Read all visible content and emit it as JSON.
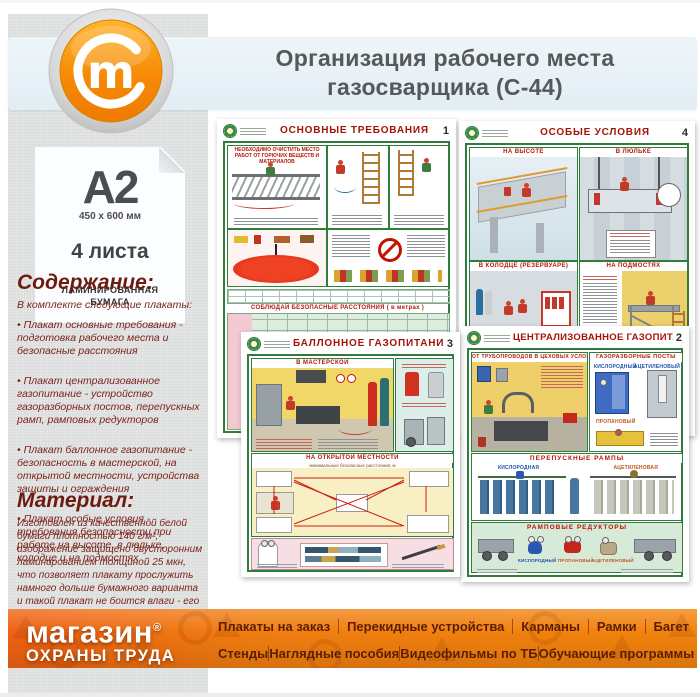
{
  "header": {
    "title_line1": "Организация рабочего места",
    "title_line2": "газосварщика (С-44)",
    "logo_letter": "m"
  },
  "sidebar": {
    "paper": {
      "format": "A2",
      "size": "450 x 600 мм",
      "sheets": "4 листа",
      "material_label": "ЛАМИНИРОВАННАЯ БУМАГА"
    },
    "contents": {
      "heading": "Содержание:",
      "intro": "В комплекте следующие плакаты:",
      "items": [
        "• Плакат основные требования - подготовка рабочего места и безопасные расстояния",
        "• Плакат централизованное газопитание - устройство газоразборных постов, перепускных рамп, рамповых редукторов",
        "• Плакат баллонное газопитание - безопасность в мастерской, на открытой местности, устройства защиты и ограждения",
        "• Плакат особые условия - требования безопасности при работе на высоте, в люльке, колодце и на подмостях"
      ]
    },
    "material": {
      "heading": "Материал:",
      "text": "Изготовлен из качественной белой бумаги плотностью 140 г/м², изображение защищено двусторонним ламинированием толщиной 25 мкн, что позволяет плакату прослужить намного дольше бумажного варианта и такой плакат не боится влаги - его смело можно протирать."
    }
  },
  "posters": {
    "p1": {
      "title": "ОСНОВНЫЕ ТРЕБОВАНИЯ",
      "number": "1",
      "s1": "НЕОБХОДИМО ОЧИСТИТЬ МЕСТО РАБОТ ОТ ГОРЮЧИХ ВЕЩЕСТВ И МАТЕРИАЛОВ",
      "s2": "СОБЛЮДАЙ БЕЗОПАСНЫЕ РАССТОЯНИЯ ( в метрах )"
    },
    "p2": {
      "title": "ОСОБЫЕ УСЛОВИЯ",
      "number": "4",
      "s1": "НА ВЫСОТЕ",
      "s2": "В ЛЮЛЬКЕ",
      "s3": "В КОЛОДЦЕ (РЕЗЕРВУАРЕ)",
      "s4": "НА ПОДМОСТЯХ"
    },
    "p3": {
      "title": "БАЛЛОННОЕ ГАЗОПИТАНИЕ",
      "number": "3",
      "s1": "В МАСТЕРСКОЙ",
      "s2": "НА ОТКРЫТОЙ МЕСТНОСТИ",
      "s2_sub": "минимальные безопасные расстояния, м"
    },
    "p4": {
      "title": "ЦЕНТРАЛИЗОВАННОЕ ГАЗОПИТАНИЕ",
      "number": "2",
      "s1": "ОТ ТРУБОПРОВОДОВ В ЦЕХОВЫХ УСЛОВИЯХ",
      "s2": "ГАЗОРАЗБОРНЫЕ ПОСТЫ",
      "s3": "ПЕРЕПУСКНЫЕ РАМПЫ",
      "s4": "РАМПОВЫЕ РЕДУКТОРЫ",
      "labels": {
        "oxygen_post": "КИСЛОРОДНЫЙ",
        "acetylene_post": "АЦЕТИЛЕНОВЫЙ",
        "propane_post": "ПРОПАНОВЫЙ",
        "oxygen_ramp": "КИСЛОРОДНАЯ",
        "acetylene_ramp": "АЦЕТИЛЕНОВАЯ",
        "oxygen_reducer": "КИСЛОРОДНЫЙ",
        "propane_reducer": "ПРОПАНОВЫЙ",
        "acetylene_reducer": "АЦЕТИЛЕНОВЫЙ"
      }
    }
  },
  "footer": {
    "brand_line1": "магазин",
    "brand_reg": "®",
    "brand_line2": "ОХРАНЫ ТРУДА",
    "menu_row1": [
      "Плакаты на заказ",
      "Перекидные устройства",
      "Карманы",
      "Рамки",
      "Багет"
    ],
    "menu_row2": [
      "Стенды",
      "Наглядные пособия",
      "Видеофильмы по ТБ",
      "Обучающие программы"
    ]
  },
  "colors": {
    "accent_orange": "#f0810e",
    "maroon_text": "#7b231a",
    "poster_green": "#2f7c3c",
    "poster_red": "#a31408",
    "band_blue": "#e7f1f7"
  }
}
